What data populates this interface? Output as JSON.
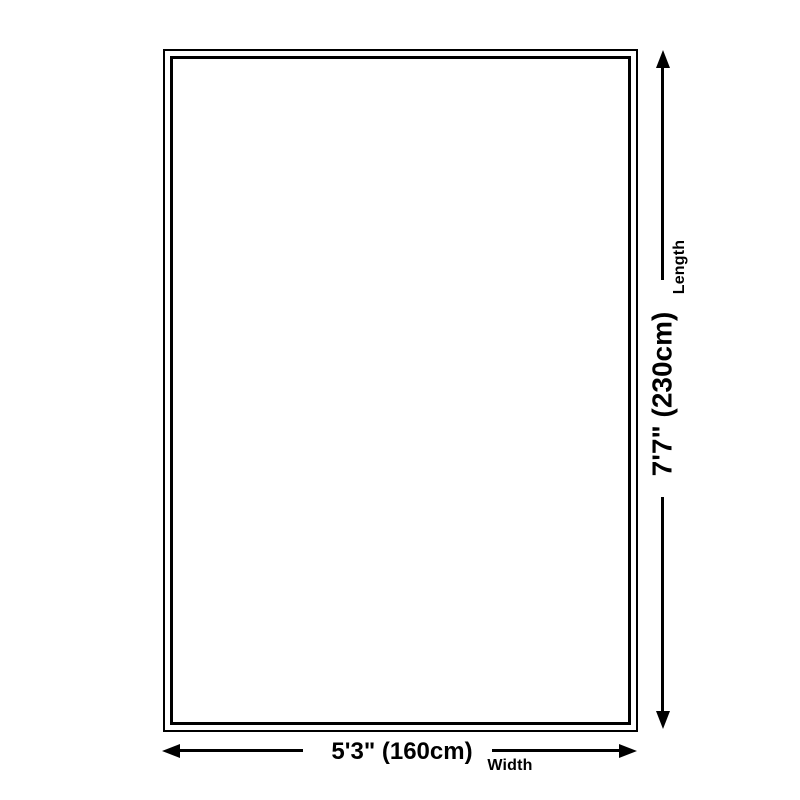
{
  "diagram": {
    "type": "product-dimension-diagram",
    "shape": "rectangle",
    "length": {
      "label": "Length",
      "value": "7'7\" (230cm)"
    },
    "width": {
      "label": "Width",
      "value": "5'3\" (160cm)"
    },
    "icons": {
      "length_start": "arrow-up-icon",
      "length_end": "arrow-down-icon",
      "width_start": "arrow-left-icon",
      "width_end": "arrow-right-icon"
    },
    "colors": {
      "line": "#000000",
      "text": "#000000",
      "background": "#ffffff"
    }
  }
}
